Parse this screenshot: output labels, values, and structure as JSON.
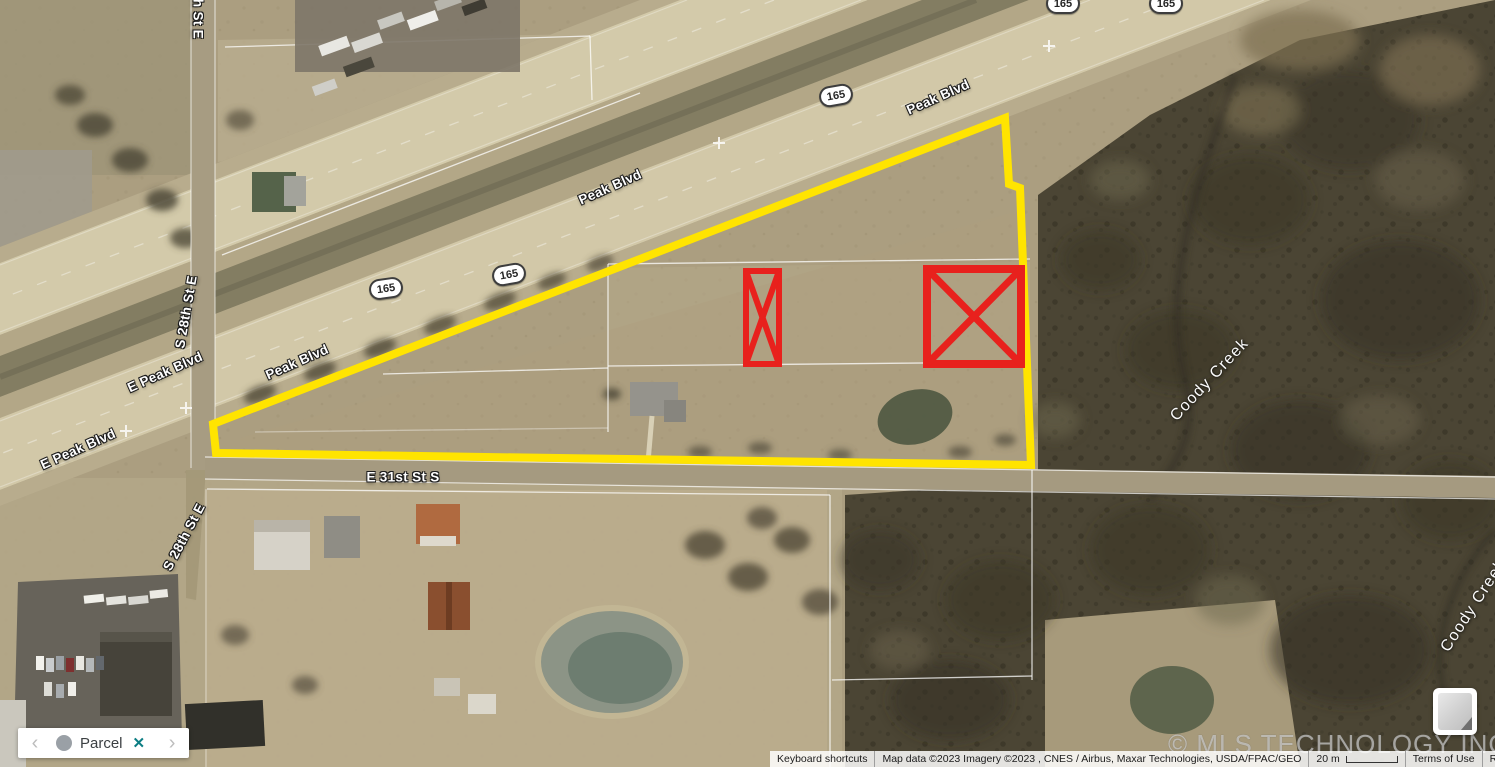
{
  "map": {
    "road_labels": [
      {
        "text": "Peak Blvd",
        "x": 938,
        "y": 97,
        "rot": -24,
        "type": "road"
      },
      {
        "text": "Peak Blvd",
        "x": 610,
        "y": 187,
        "rot": -24,
        "type": "road"
      },
      {
        "text": "Peak Blvd",
        "x": 297,
        "y": 362,
        "rot": -24,
        "type": "road"
      },
      {
        "text": "E Peak Blvd",
        "x": 165,
        "y": 372,
        "rot": -24,
        "type": "road"
      },
      {
        "text": "E Peak Blvd",
        "x": 78,
        "y": 449,
        "rot": -24,
        "type": "road"
      },
      {
        "text": "E 31st St S",
        "x": 403,
        "y": 477,
        "rot": 0,
        "type": "road"
      },
      {
        "text": "S 28th St E",
        "x": 198,
        "y": 2,
        "rot": 90,
        "type": "road"
      },
      {
        "text": "S 28th St E",
        "x": 186,
        "y": 312,
        "rot": -80,
        "type": "road"
      },
      {
        "text": "S 28th St E",
        "x": 184,
        "y": 537,
        "rot": -62,
        "type": "road"
      },
      {
        "text": "Coody Creek",
        "x": 1210,
        "y": 380,
        "rot": -47,
        "type": "water"
      },
      {
        "text": "Coody Creek",
        "x": 1474,
        "y": 606,
        "rot": -57,
        "type": "water"
      }
    ],
    "route_shields": [
      {
        "text": "165",
        "x": 1063,
        "y": 3,
        "rot": 0
      },
      {
        "text": "165",
        "x": 1166,
        "y": 3,
        "rot": 0
      },
      {
        "text": "165",
        "x": 836,
        "y": 95,
        "rot": -10
      },
      {
        "text": "165",
        "x": 509,
        "y": 274,
        "rot": -10
      },
      {
        "text": "165",
        "x": 386,
        "y": 288,
        "rot": -8
      }
    ],
    "watermark": "© MLS TECHNOLOGY INC 2025",
    "parcel_outline_color": "#ffe400",
    "highlight_color": "#e8211d"
  },
  "parcel_bar": {
    "prev_label": "‹",
    "next_label": "›",
    "label": "Parcel",
    "close_label": "✕",
    "close_color": "#0c7d83"
  },
  "attribution": {
    "keyboard_shortcuts": "Keyboard shortcuts",
    "map_data": "Map data ©2023 Imagery ©2023 , CNES / Airbus, Maxar Technologies, USDA/FPAC/GEO",
    "scale_text": "20 m",
    "terms": "Terms of Use",
    "report": "Report a map error"
  }
}
